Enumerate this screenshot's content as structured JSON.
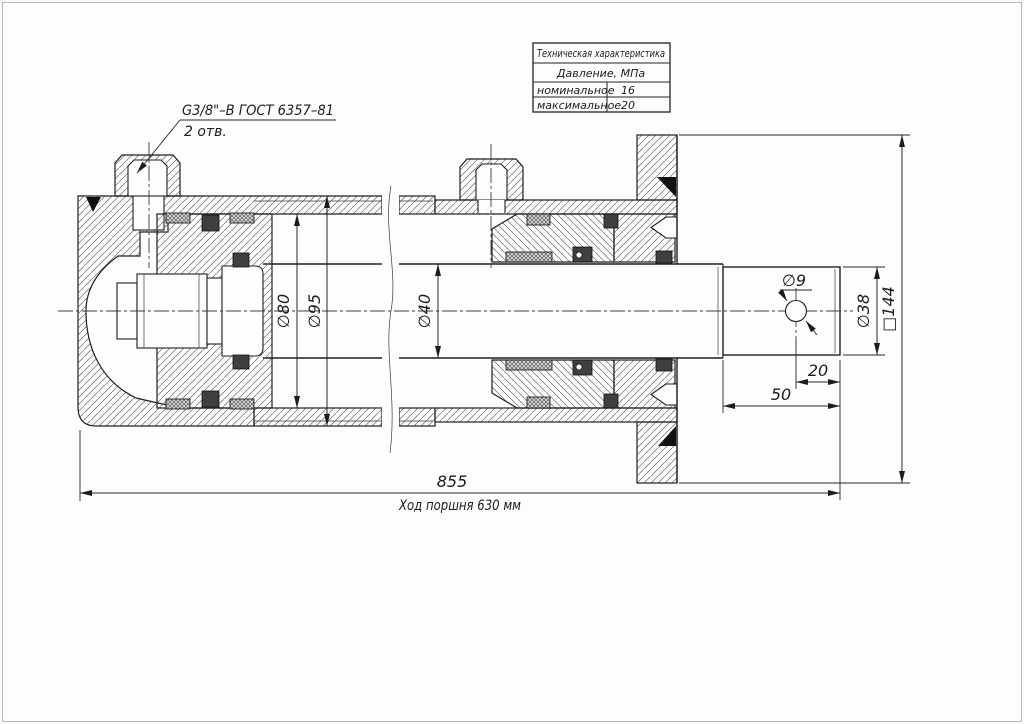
{
  "drawing": {
    "port_label": {
      "line1": "G3/8\"–В ГОСТ 6357–81",
      "line2": "2 отв."
    },
    "table": {
      "title": "Техническая характеристика",
      "subtitle": "Давление, МПа",
      "rows": [
        {
          "param": "номинальное",
          "value": "16"
        },
        {
          "param": "максимальное",
          "value": "20"
        }
      ]
    },
    "dims": {
      "bore": "∅80",
      "outer_dia": "∅95",
      "rod_dia": "∅40",
      "hole_dia": "∅9",
      "tip_dia": "∅38",
      "flange_sq": "□144",
      "hole_to_end": "20",
      "tip_len": "50",
      "overall": "855",
      "stroke_note": "Ход поршня 630 мм"
    }
  }
}
